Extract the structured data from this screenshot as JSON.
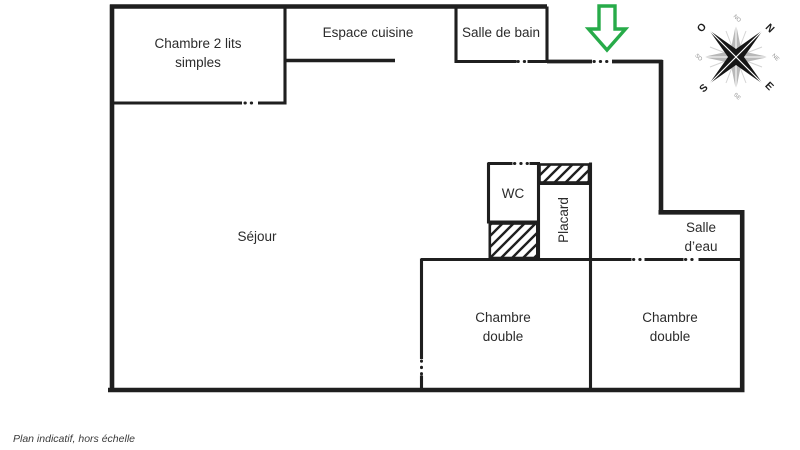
{
  "caption": "Plan indicatif, hors échelle",
  "colors": {
    "wall": "#1f1f1f",
    "text": "#2b2b2b",
    "arrow_green": "#27ab49",
    "compass_gray": "#b8b8b8"
  },
  "rooms": {
    "bedroom_twin": {
      "line1": "Chambre 2 lits",
      "line2": "simples"
    },
    "kitchen": {
      "label": "Espace cuisine"
    },
    "bathroom": {
      "label": "Salle de bain"
    },
    "living": {
      "label": "Séjour"
    },
    "wc": {
      "label": "WC"
    },
    "closet": {
      "label": "Placard"
    },
    "shower_room": {
      "line1": "Salle",
      "line2": "d’eau"
    },
    "bedroom_double_left": {
      "line1": "Chambre",
      "line2": "double"
    },
    "bedroom_double_right": {
      "line1": "Chambre",
      "line2": "double"
    }
  },
  "compass": {
    "west": "O",
    "north": "N",
    "south": "S",
    "east": "E",
    "nw": "NO",
    "ne": "NE",
    "se": "SE",
    "sw": "SO"
  }
}
